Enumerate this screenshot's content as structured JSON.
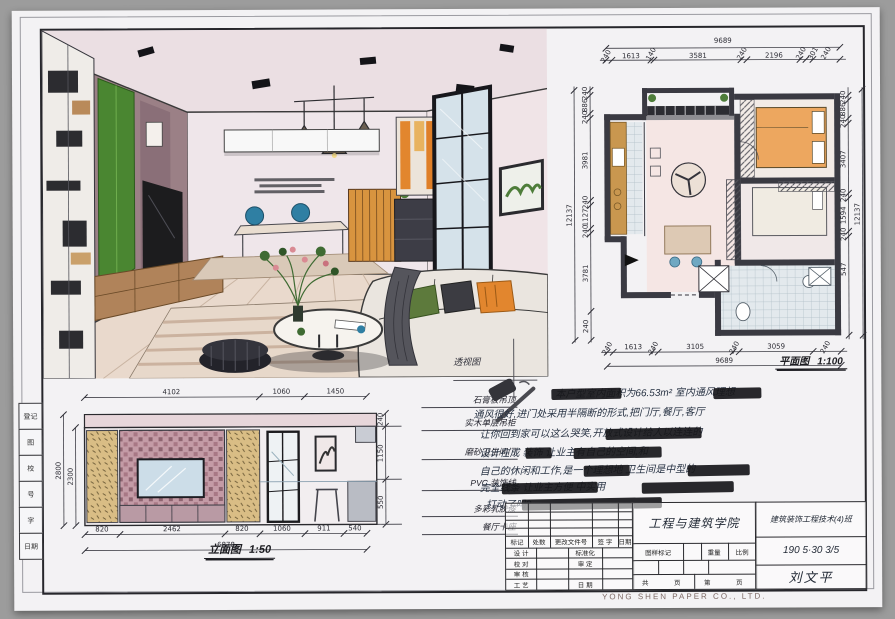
{
  "sheet": {
    "edge_labels": [
      "登记",
      "图",
      "校",
      "号",
      "字",
      "日期"
    ],
    "watermark": "YONG SHEN PAPER CO., LTD.",
    "colors": {
      "paper": "#f3f2f4",
      "frame": "#26262b",
      "wall": "#3a3a42",
      "pink_wash": "#ecdcde",
      "green_panel": "#4a8631",
      "teal": "#2f7fa3",
      "orange": "#e2862e",
      "wood": "#b98a5a"
    }
  },
  "perspective": {
    "caption": "透视图"
  },
  "floor_plan": {
    "caption": "平面图",
    "scale": "1:100",
    "total_top": "9689",
    "total_bottom": "9689",
    "total_left": "12137",
    "total_right": "12137",
    "dims_top": [
      "240",
      "1613",
      "140",
      "3581",
      "240",
      "2196",
      "240",
      "301",
      "240"
    ],
    "dims_bottom": [
      "240",
      "1613",
      "240",
      "3105",
      "240",
      "3059",
      "240"
    ],
    "dims_left": [
      "240",
      "886",
      "240",
      "3981",
      "240",
      "1127",
      "240",
      "3781",
      "240"
    ],
    "dims_right": [
      "240",
      "886",
      "240",
      "3407",
      "240",
      "1594",
      "240",
      "547"
    ]
  },
  "elevation": {
    "caption": "立面图",
    "scale": "1:50",
    "total_bottom": "6878",
    "dims_top": [
      "4102",
      "1060",
      "1450"
    ],
    "dims_bottom": [
      "820",
      "2462",
      "820",
      "1060",
      "911",
      "540"
    ],
    "dims_left": [
      "2800",
      "2300"
    ],
    "dims_right": [
      "240",
      "1150",
      "550"
    ]
  },
  "material_labels": [
    "石膏板吊顶",
    "实木单层吊柜",
    "磨砂卫生间门",
    "PVC 装饰线",
    "多彩乳胶漆",
    "餐厅卡座"
  ],
  "notes": {
    "lines": [
      "本户型室内面积为66.53m² 室内通风理想",
      "通风很好,进门处采用半隔断的形式,把门厅,餐厅,客厅",
      "让你回到家可以这么哭笑,开放式设计给人以连连的",
      "设计在成 装饰 让业主有自己的空间,和",
      "自己的休闲和工作,是一个理想地 卫生间是中型的",
      "完全线条 让业主方便 中实用",
      "打动了吗?"
    ]
  },
  "title_block": {
    "rev_header": [
      "标记",
      "处数",
      "更改文件号",
      "签 字",
      "日期"
    ],
    "row_labels": {
      "design": "设 计",
      "proof": "校 对",
      "review": "审 核",
      "craft": "工 艺",
      "standard": "标准化",
      "approve": "审 定",
      "date": "日 期"
    },
    "school": "工程与建筑学院",
    "class_name": "建筑装饰工程技术(4)班",
    "stamp_label": "图样标记",
    "weight_label": "重量",
    "scale_label": "比例",
    "date_code": "190 5·30 3/5",
    "pages": [
      "共",
      "页",
      "第",
      "页"
    ],
    "signature": "刘文平"
  }
}
